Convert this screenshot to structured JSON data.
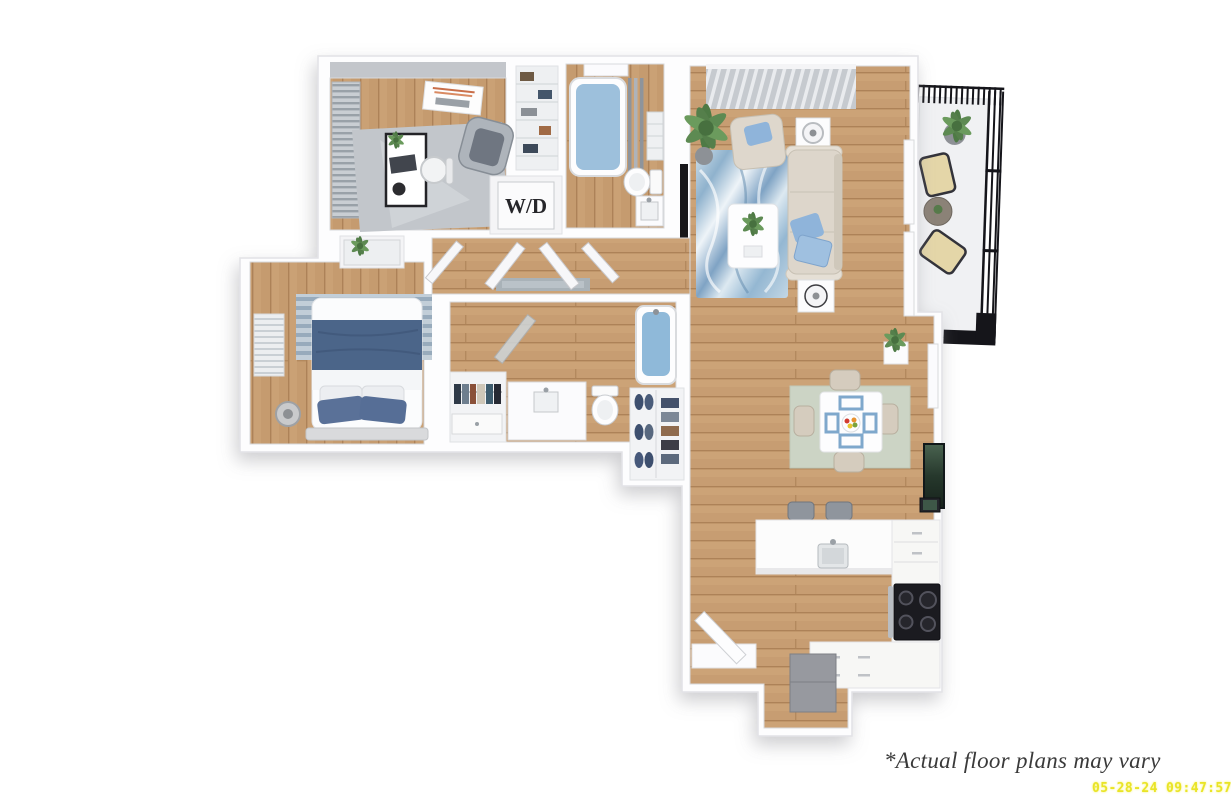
{
  "canvas": {
    "width": 1231,
    "height": 807,
    "background": "#ffffff"
  },
  "footer": {
    "disclaimer": "*Actual floor plans may vary",
    "timestamp": "05-28-24 09:47:57"
  },
  "floor_plan": {
    "view": "3d-top-down-apartment-rendering",
    "wd_label": "W/D",
    "rooms": [
      {
        "name": "office-bedroom",
        "contents": [
          "desk",
          "monitor",
          "office-chair",
          "accent-chair",
          "gray-area-rug",
          "window-blinds",
          "wall-art",
          "shelved-closet"
        ]
      },
      {
        "name": "hall-bathroom",
        "contents": [
          "bathtub",
          "shower-curtain",
          "toilet",
          "vanity-sink",
          "linen-shelves",
          "window"
        ]
      },
      {
        "name": "laundry-closet",
        "contents": [
          "stacked-washer-dryer"
        ]
      },
      {
        "name": "hallway",
        "contents": [
          "runner-rug",
          "open-doors"
        ]
      },
      {
        "name": "living-room",
        "contents": [
          "sofa",
          "accent-chair",
          "blue-throw-pillows",
          "coffee-table",
          "side-tables",
          "lamps",
          "blue-marble-rug",
          "wall-tv",
          "media-console",
          "palm-plant",
          "slatted-window-wall",
          "windows"
        ]
      },
      {
        "name": "balcony",
        "contents": [
          "metal-railing",
          "lounge-chairs",
          "side-table",
          "potted-plants"
        ]
      },
      {
        "name": "primary-bedroom",
        "contents": [
          "bed-navy-bedding",
          "pillows",
          "striped-rug",
          "dresser-with-plant",
          "stool",
          "window-blinds"
        ]
      },
      {
        "name": "walk-in-closet",
        "contents": [
          "hanging-clothes",
          "low-dresser"
        ]
      },
      {
        "name": "primary-bathroom",
        "contents": [
          "bathtub",
          "toilet",
          "vanity-sink",
          "glass-door"
        ]
      },
      {
        "name": "shoe-closet",
        "contents": [
          "shoes",
          "folded-clothes"
        ]
      },
      {
        "name": "dining-area",
        "contents": [
          "square-table",
          "four-chairs",
          "placemats",
          "fruit-bowl",
          "sage-rug",
          "wall-art"
        ]
      },
      {
        "name": "kitchen",
        "contents": [
          "breakfast-bar",
          "bar-stools",
          "sink",
          "stove-cooktop",
          "cabinets",
          "drawers",
          "refrigerator",
          "entry-door",
          "console"
        ]
      }
    ],
    "colors": {
      "wood_floor": "#c59b6f",
      "wall": "#fdfdfe",
      "wall_edge": "#e2e2e6",
      "tub_water": "#93bcd9",
      "accent_blue": "#8fb4da",
      "navy_bedding": "#4b6589",
      "living_rug_blue": "#7fa3c4",
      "dining_rug_sage": "#ccd4c5",
      "balcony_rail": "#15151a",
      "stove_black": "#1b1b20",
      "timestamp_yellow": "#e9e426",
      "disclaimer_text": "#3a3a3a"
    }
  }
}
